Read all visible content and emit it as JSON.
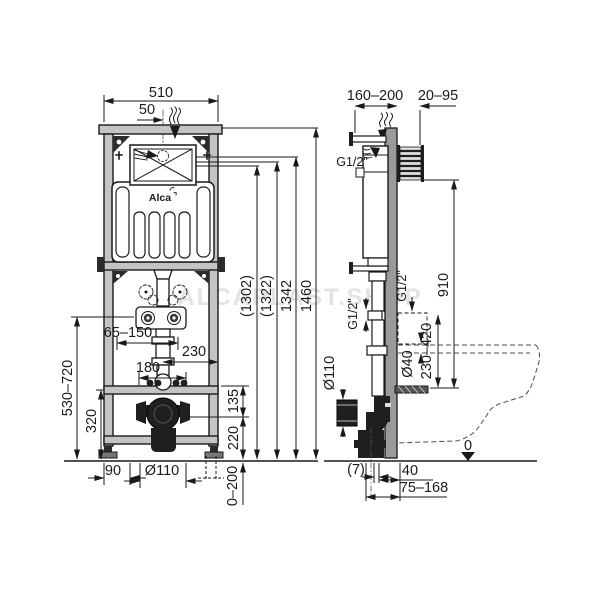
{
  "watermark": "ALCAPLAST.SHOP",
  "logo": "Alca",
  "front": {
    "w510": "510",
    "w50": "50",
    "h1302": "(1302)",
    "h1322": "(1322)",
    "h1342": "1342",
    "h1460": "1460",
    "v530_720": "530–720",
    "v320": "320",
    "d65_150": "65–150",
    "d230": "230",
    "d180": "180",
    "v135": "135",
    "v220": "220",
    "b90": "90",
    "b110": "Ø110",
    "b0_200": "0–200"
  },
  "side": {
    "t160_200": "160–200",
    "t20_95": "20–95",
    "g12_top": "G1/2\"",
    "g12_left": "G1/2\"",
    "g12_right": "G1/2\"",
    "v910": "910",
    "v230_420": "230–420",
    "d40": "Ø40",
    "d110": "Ø110",
    "zero": "0",
    "b7": "(7)",
    "b40": "40",
    "b75_168": "75–168"
  },
  "colors": {
    "line": "#1a1a1a",
    "steel": "#c4c4c4",
    "wall": "#9a9a9a",
    "dark": "#1f1f1f"
  }
}
